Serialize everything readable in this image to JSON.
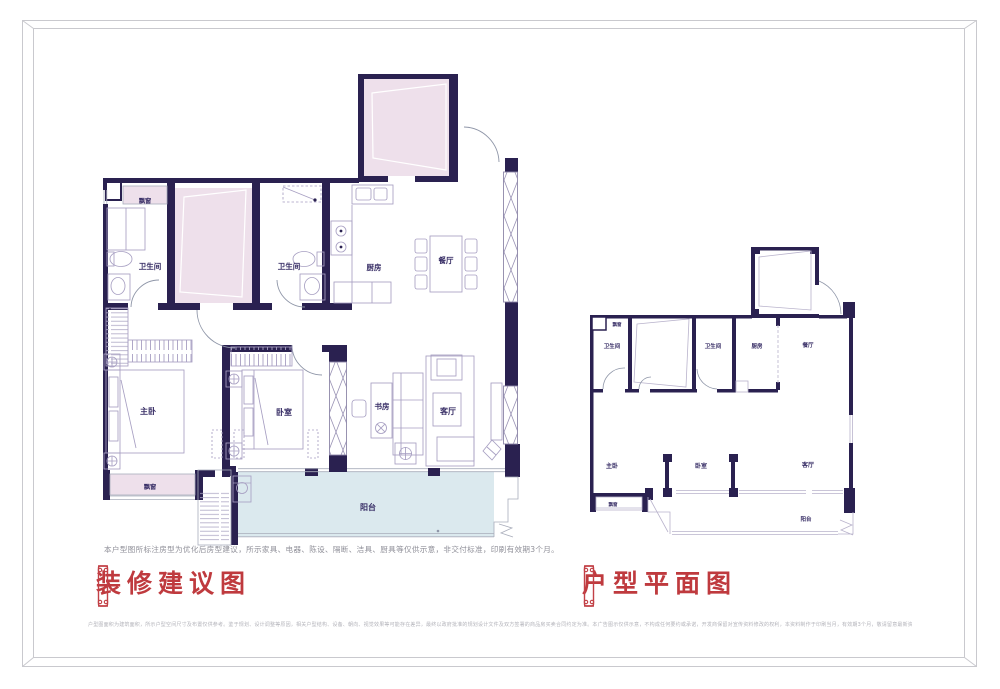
{
  "colors": {
    "wall": "#2a2150",
    "furniture_line": "#a79fc2",
    "pink_fill": "#eee0eb",
    "blue_fill": "#dbe9ee",
    "title_red": "#bf3a3e",
    "label_navy": "#382e66",
    "frame_gray": "#c9c9ce"
  },
  "left_plan": {
    "title": "装修建议图",
    "note": "本户型图所标注房型为优化后房型建议，所示家具、电器、陈设、隔断、洁具、厨具等仅供示意，非交付标准，印刷有效期3个月。",
    "labels": {
      "bay_top": "飘窗",
      "bath_1": "卫生间",
      "bath_2": "卫生间",
      "kitchen": "厨房",
      "dining": "餐厅",
      "master": "主卧",
      "bedroom": "卧室",
      "study": "书房",
      "living": "客厅",
      "balcony": "阳台",
      "bay_bottom": "飘窗"
    }
  },
  "right_plan": {
    "title": "户型平面图",
    "labels": {
      "bay_top": "飘窗",
      "bath_1": "卫生间",
      "bath_2": "卫生间",
      "kitchen": "厨房",
      "dining": "餐厅",
      "master": "主卧",
      "bedroom": "卧室",
      "living": "客厅",
      "balcony": "阳台",
      "bay_bottom": "飘窗"
    }
  },
  "footer": {
    "disclaimer": "户型图面积为建筑面积，所示户型空间尺寸及布置仅供参考。鉴于规划、设计调整等原因，相关户型结构、设备、朝向、视觉效果等可能存在差异，最终以政府批准的规划设计文件及双方签署的商品房买卖合同约定为准。本广告图示仅供示意，不构成任何要约或承诺，开发商保留对宣传资料修改的权利，本资料制作于印刷当月，有效期3个月，敬请留意最新资料。"
  }
}
